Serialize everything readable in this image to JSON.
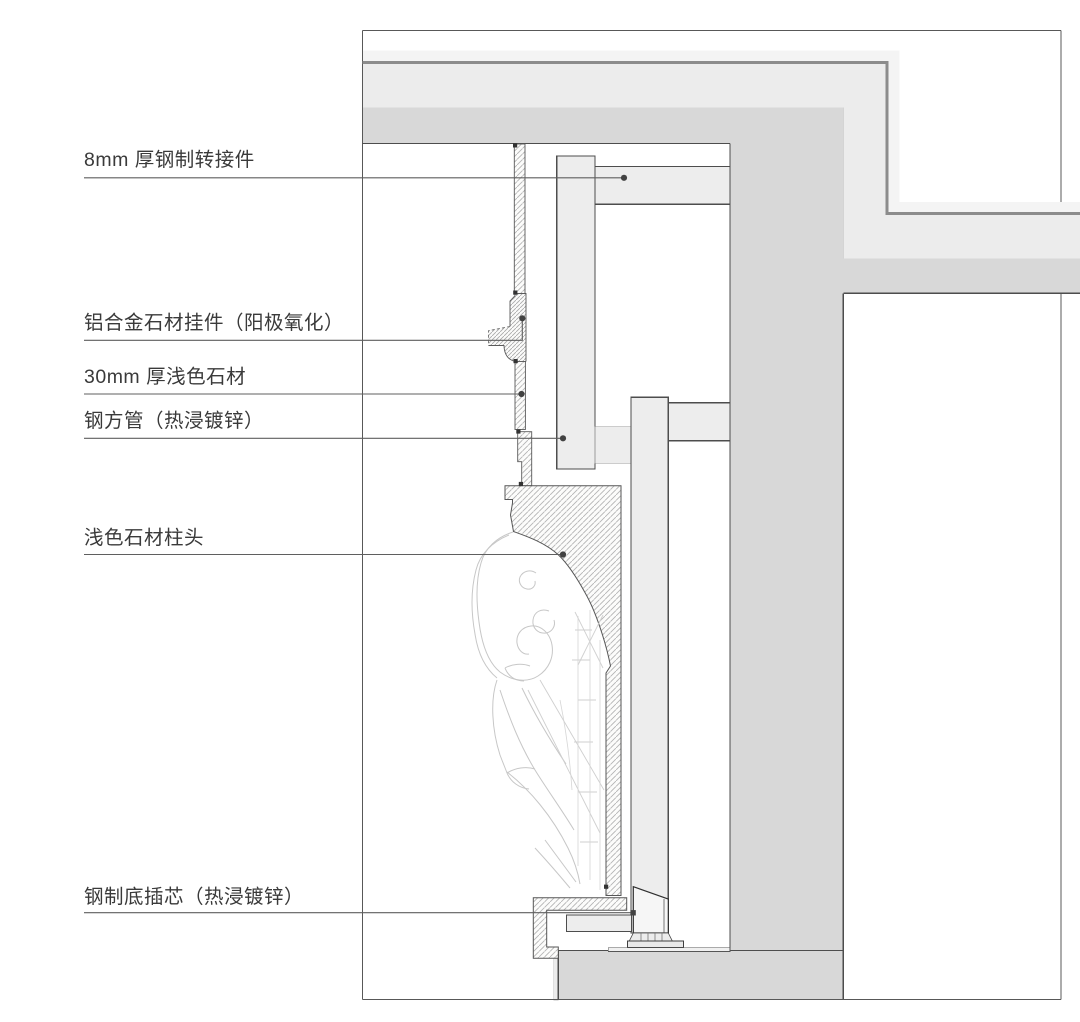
{
  "figure": {
    "kind": "architectural-section-detail",
    "language": "zh-CN"
  },
  "callouts": [
    {
      "id": "steel-adapter",
      "text": "8mm 厚钢制转接件"
    },
    {
      "id": "aluminum-stone-hanger",
      "text": "铝合金石材挂件（阳极氧化）"
    },
    {
      "id": "light-stone-panel",
      "text": "30mm 厚浅色石材"
    },
    {
      "id": "steel-square-tube",
      "text": "钢方管（热浸镀锌）"
    },
    {
      "id": "stone-capital",
      "text": "浅色石材柱头"
    },
    {
      "id": "steel-bottom-insert",
      "text": "钢制底插芯（热浸镀锌）"
    }
  ],
  "colors": {
    "line_dark": "#4d4d4d",
    "frame": "#585858",
    "thick_band_line": "#8c8c8c",
    "wall_fill": "#d8d8d8",
    "finish_fill": "#ececec",
    "faint_fill": "#f4f4f4",
    "steel_fill": "#ededed",
    "hatch_line": "#b3b3b3",
    "ornament_line": "#c7c7c7",
    "label_text": "#3a3a3a"
  }
}
